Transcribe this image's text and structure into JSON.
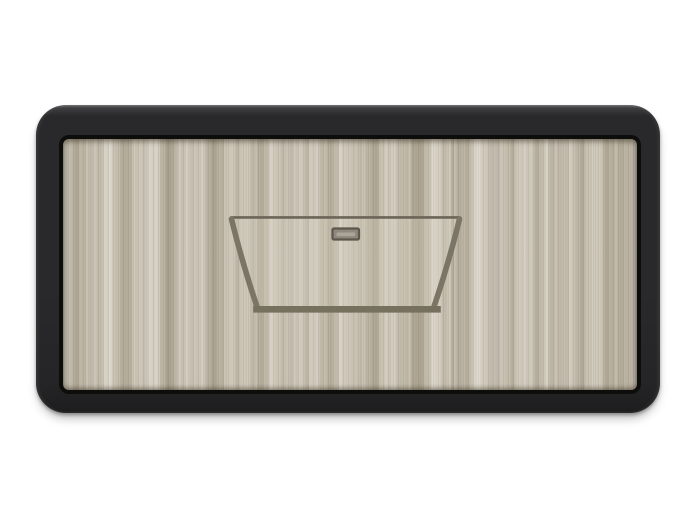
{
  "colors": {
    "background": "#ffffff",
    "frame_dark": "#29292b",
    "frame_edge_highlight": "#6a6a6e",
    "frame_inner_line": "#0d0d0c",
    "wood_base": "#c7c0b0",
    "wood_light": "#d9d4c7",
    "wood_dark": "#a9a18f",
    "tub_interior_haze": "rgba(213,207,193,0.30)",
    "rim_stroke": "#6b6557",
    "outline_stroke": "#7b7566",
    "bottom_stroke": "#76705f",
    "overflow_border": "#5c564c",
    "overflow_fill": "#8f897d",
    "overflow_highlight": "rgba(196,190,178,0.55)"
  }
}
